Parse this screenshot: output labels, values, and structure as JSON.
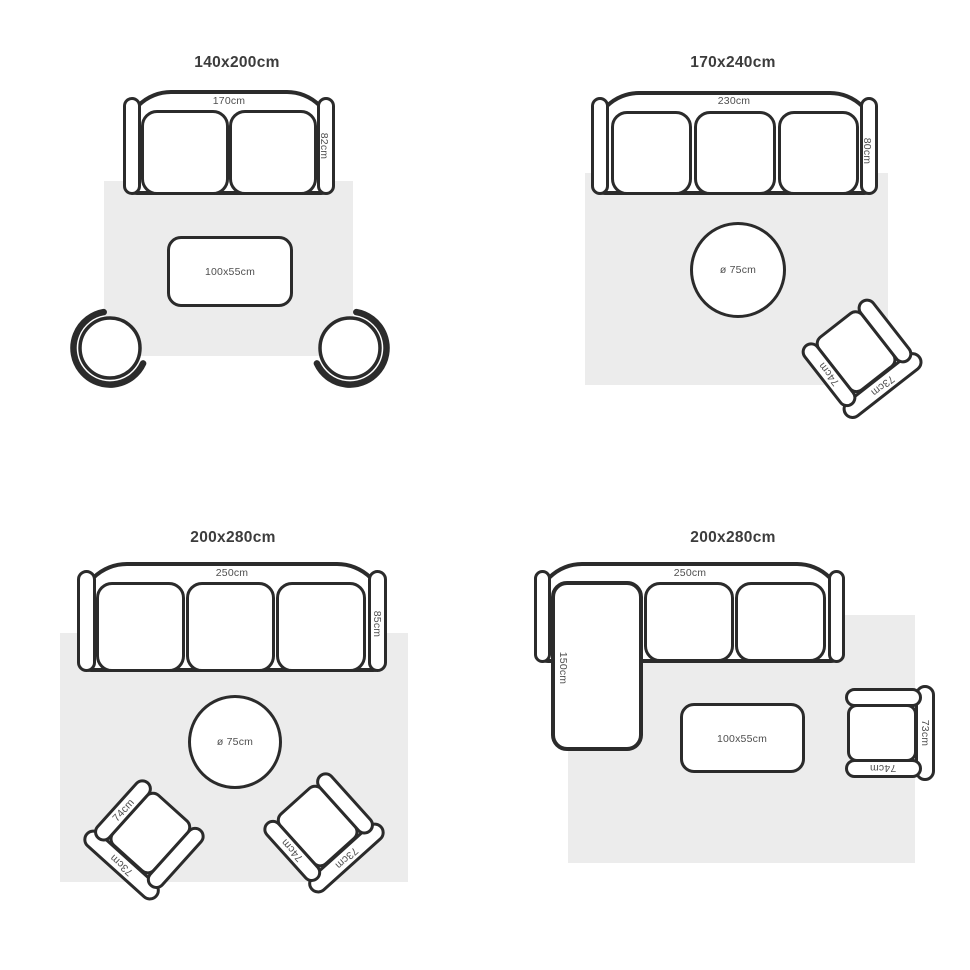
{
  "colors": {
    "outline": "#2b2b2b",
    "rug_fill": "#ececec",
    "title_text": "#3c3c3c",
    "dimension_text": "#4f4f4f",
    "background": "#ffffff"
  },
  "layouts": [
    {
      "position": "top-left",
      "title": "140x200cm",
      "sofa": {
        "width_label": "170cm",
        "depth_label": "82cm"
      },
      "coffee_table": {
        "label": "100x55cm"
      }
    },
    {
      "position": "top-right",
      "title": "170x240cm",
      "sofa": {
        "width_label": "230cm",
        "depth_label": "80cm"
      },
      "round_table": {
        "label": "ø 75cm"
      },
      "armchair": {
        "arm_label": "74cm",
        "back_label": "73cm"
      }
    },
    {
      "position": "bottom-left",
      "title": "200x280cm",
      "sofa": {
        "width_label": "250cm",
        "depth_label": "85cm"
      },
      "round_table": {
        "label": "ø 75cm"
      },
      "armchair_left": {
        "arm_label": "74cm",
        "back_label": "73cm"
      },
      "armchair_right": {
        "arm_label": "74cm",
        "back_label": "73cm"
      }
    },
    {
      "position": "bottom-right",
      "title": "200x280cm",
      "sofa": {
        "width_label": "250cm",
        "chaise_label": "150cm"
      },
      "coffee_table": {
        "label": "100x55cm"
      },
      "armchair": {
        "arm_label": "74cm",
        "back_label": "73cm"
      }
    }
  ]
}
